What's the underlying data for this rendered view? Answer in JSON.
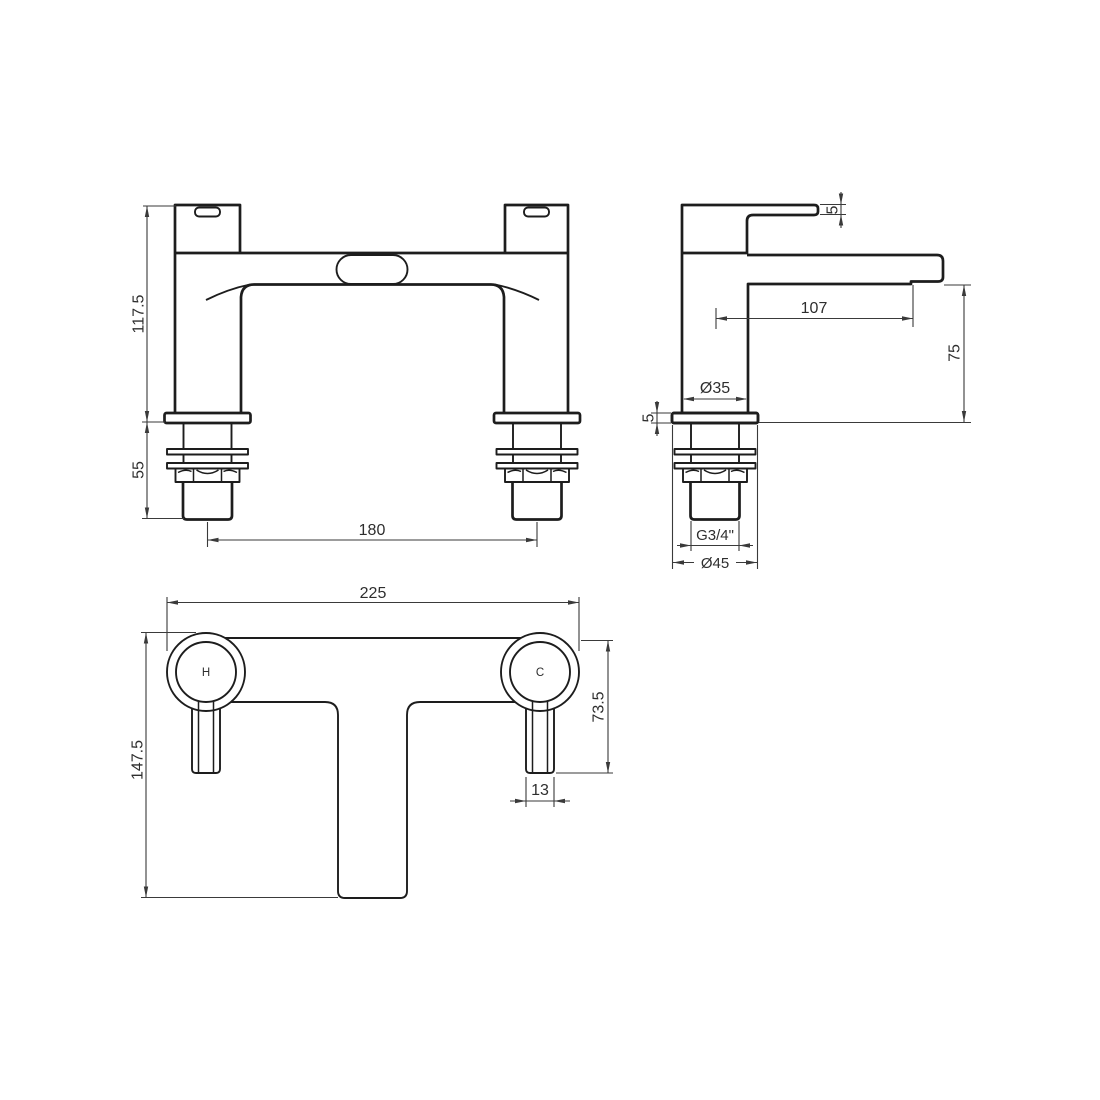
{
  "drawing": {
    "type": "technical-orthographic-drawing",
    "subject": "bath filler tap (two pillar mixer)",
    "colors": {
      "background": "#ffffff",
      "part_line": "#1d1d1d",
      "dimension_line": "#3a3a3a",
      "text": "#2e2e2e"
    },
    "labels": {
      "front": {
        "body_height": "117.5",
        "shank_length": "55",
        "hole_centres": "180"
      },
      "side": {
        "handle_thickness": "5",
        "spout_reach": "107",
        "spout_height": "75",
        "body_diameter": "Ø35",
        "flange_thickness": "5",
        "thread_size": "G3/4\"",
        "flange_diameter": "Ø45"
      },
      "plan": {
        "overall_width": "225",
        "overall_depth": "147.5",
        "handle_projection": "73.5",
        "lever_width": "13",
        "hot_indicator": "H",
        "cold_indicator": "C"
      }
    }
  }
}
